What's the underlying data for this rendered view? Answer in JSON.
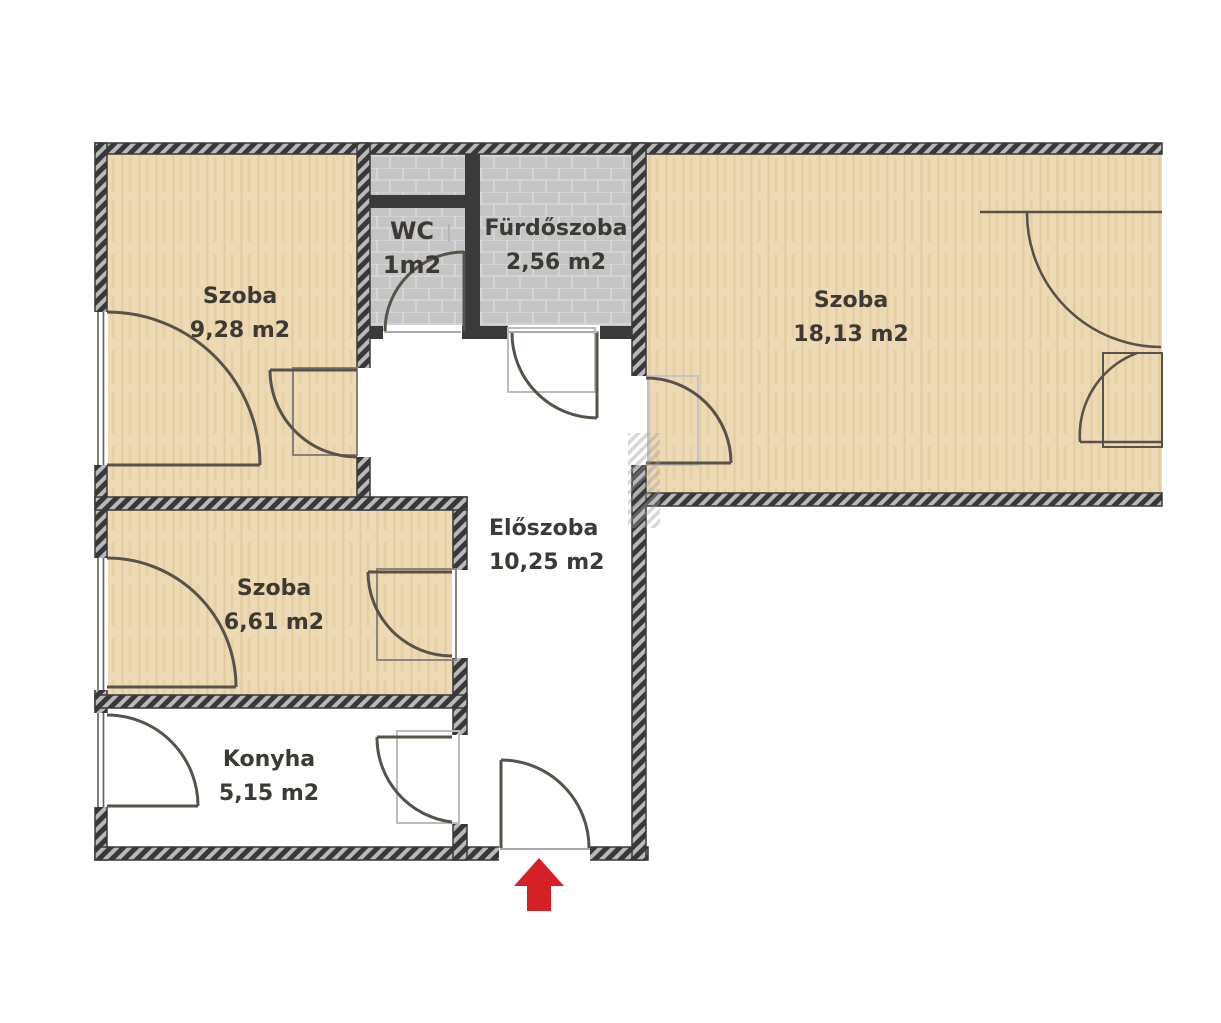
{
  "title": "Apartment floor plan",
  "rooms": [
    {
      "name": "Szoba",
      "area": "9,28 m2"
    },
    {
      "name": "WC",
      "area": "1m2"
    },
    {
      "name": "Fürdőszoba",
      "area": "2,56 m2"
    },
    {
      "name": "Szoba",
      "area": "18,13 m2"
    },
    {
      "name": "Előszoba",
      "area": "10,25 m2"
    },
    {
      "name": "Szoba",
      "area": "6,61 m2"
    },
    {
      "name": "Konyha",
      "area": "5,15 m2"
    }
  ],
  "entrance": {
    "marker": "red-arrow-up"
  },
  "colors": {
    "wood_floor": "#edd9b3",
    "tile_floor": "#c5c5c5",
    "wall_dark": "#3a3a3a",
    "door_line": "#57524a",
    "arrow_red": "#d42026",
    "label_text": "#3d3a35"
  }
}
